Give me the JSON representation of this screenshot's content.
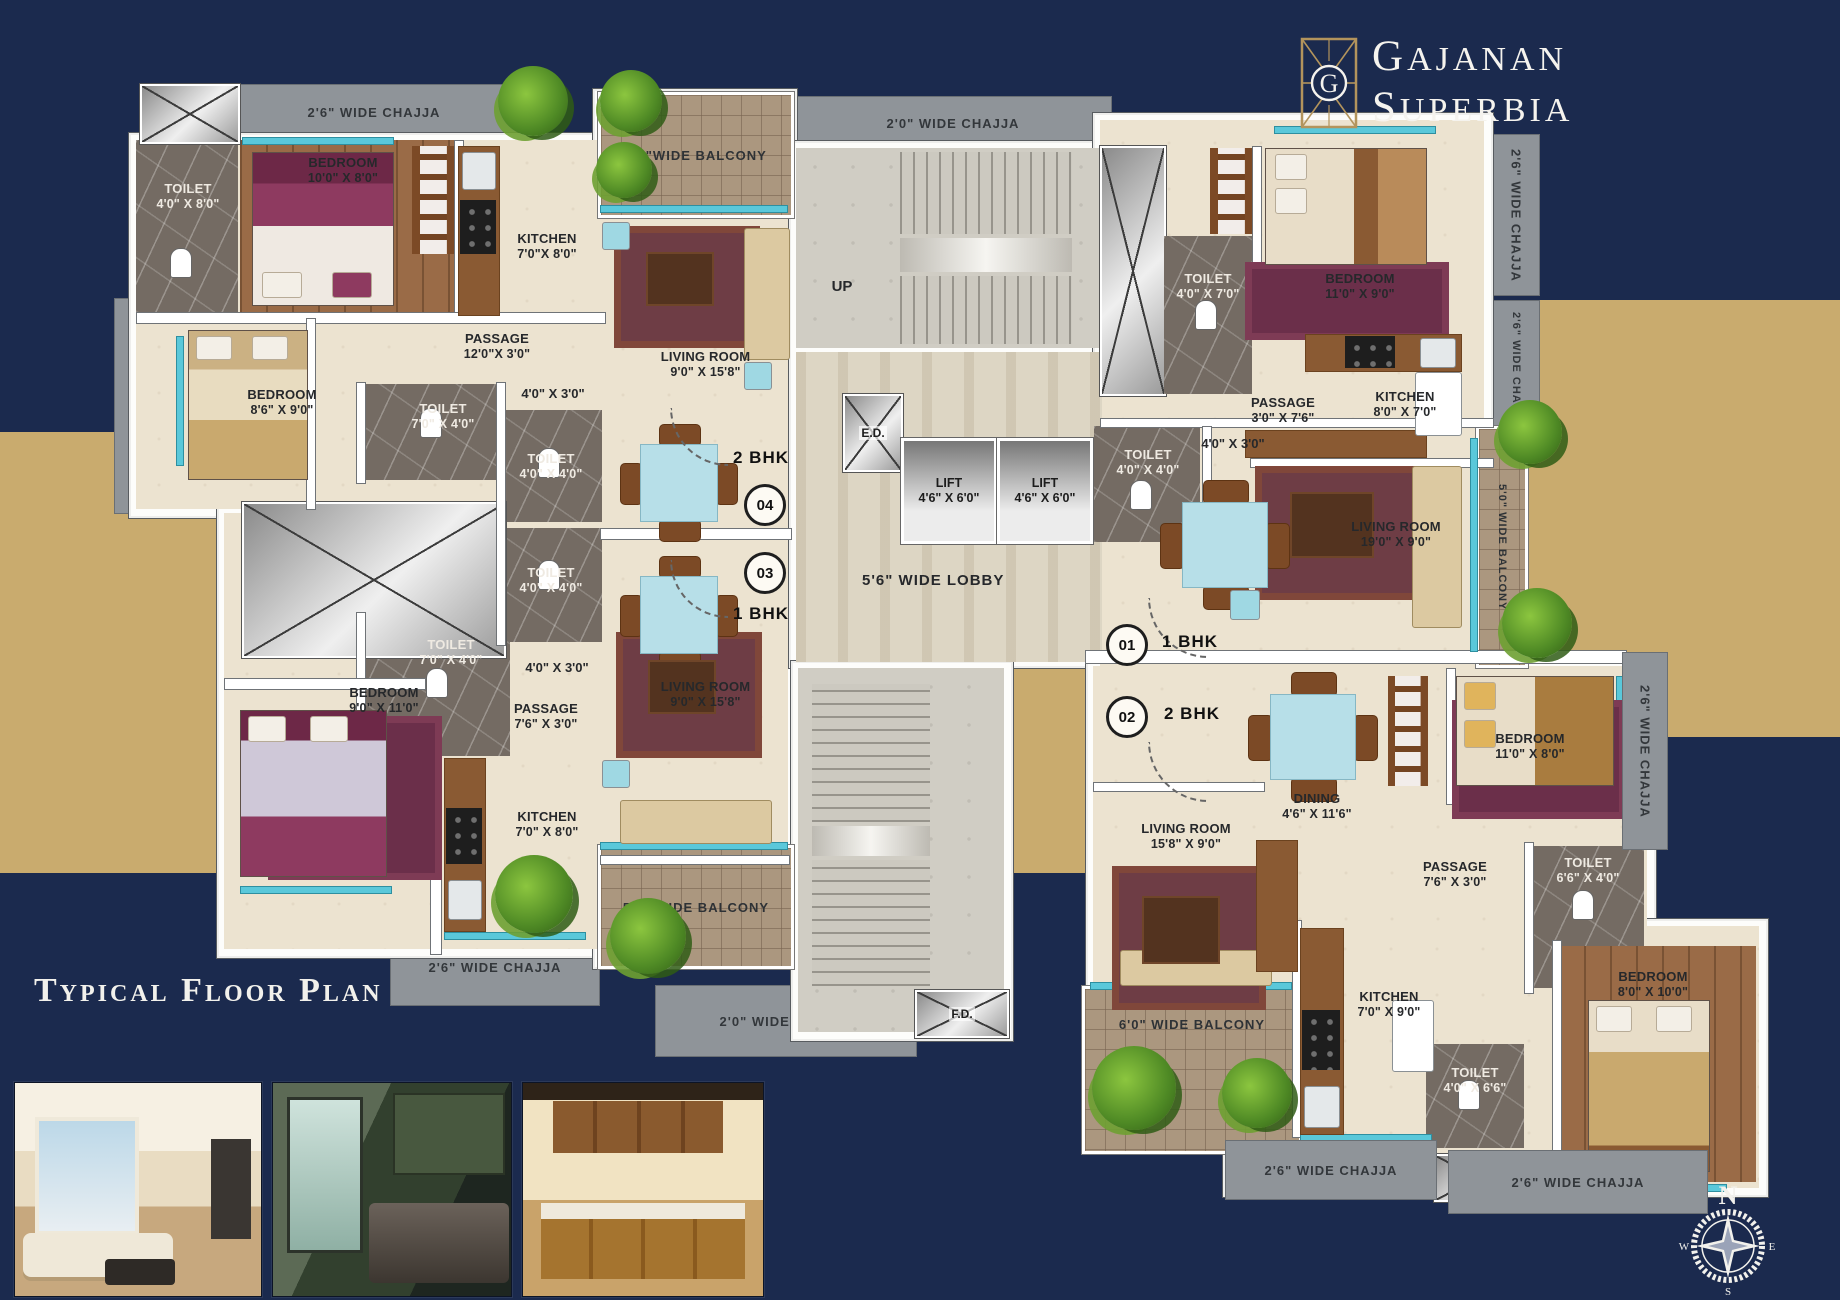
{
  "brand": {
    "line1": "GAJANAN",
    "line2": "SUPERBIA",
    "monogram": "G"
  },
  "title": "Typical Floor Plan",
  "compass": {
    "north": "N",
    "east": "E",
    "south": "S",
    "west": "W"
  },
  "colors": {
    "navy": "#1b2a4e",
    "gold": "#c9ab6e",
    "chajja_gray": "#8f9499",
    "floor_beige": "#ece3d0",
    "accent_teal": "#5ac8da",
    "logo_gold": "#b3945c"
  },
  "core": {
    "up": "UP",
    "ed": "E.D.",
    "fd": "F.D.",
    "lobby": "5'6\" WIDE LOBBY",
    "lift1": {
      "name": "LIFT",
      "dims": "4'6\" X 6'0\""
    },
    "lift2": {
      "name": "LIFT",
      "dims": "4'6\" X 6'0\""
    }
  },
  "flats": [
    {
      "number": "04",
      "type": "2 BHK"
    },
    {
      "number": "03",
      "type": "1 BHK"
    },
    {
      "number": "01",
      "type": "1 BHK"
    },
    {
      "number": "02",
      "type": "2 BHK"
    }
  ],
  "rooms": {
    "toilet_l1": {
      "name": "TOILET",
      "dims": "4'0\" X 8'0\""
    },
    "bedroom_l1": {
      "name": "BEDROOM",
      "dims": "10'0\" X 8'0\""
    },
    "kitchen_l1": {
      "name": "KITCHEN",
      "dims": "7'0\"X 8'0\""
    },
    "living_l1": {
      "name": "LIVING ROOM",
      "dims": "9'0\" X 15'8\""
    },
    "passage_l1": {
      "name": "PASSAGE",
      "dims": "12'0\"X 3'0\""
    },
    "bedroom_l2": {
      "name": "BEDROOM",
      "dims": "8'6\" X 9'0\""
    },
    "toilet_l2": {
      "name": "TOILET",
      "dims": "7'0\" X 4'0\""
    },
    "toilet_l3": {
      "name": "TOILET",
      "dims": "4'0\" X 4'0\""
    },
    "toilet_l4": {
      "name": "TOILET",
      "dims": "4'0\" X 4'0\""
    },
    "toilet_l5": {
      "name": "TOILET",
      "dims": "7'0\" X 4'0\""
    },
    "bedroom_l3": {
      "name": "BEDROOM",
      "dims": "9'0\" X 11'0\""
    },
    "passage_l2": {
      "name": "PASSAGE",
      "dims": "7'6\" X 3'0\""
    },
    "living_l2": {
      "name": "LIVING ROOM",
      "dims": "9'0\" X 15'8\""
    },
    "kitchen_l2": {
      "name": "KITCHEN",
      "dims": "7'0\" X 8'0\""
    },
    "toilet_r1": {
      "name": "TOILET",
      "dims": "4'0\" X 7'0\""
    },
    "bedroom_r1": {
      "name": "BEDROOM",
      "dims": "11'0\" X 9'0\""
    },
    "kitchen_r1": {
      "name": "KITCHEN",
      "dims": "8'0\" X 7'0\""
    },
    "passage_r1": {
      "name": "PASSAGE",
      "dims": "3'0\" X 7'6\""
    },
    "toilet_r2": {
      "name": "TOILET",
      "dims": "4'0\" X 4'0\""
    },
    "living_r1": {
      "name": "LIVING ROOM",
      "dims": "19'0\" X 9'0\""
    },
    "dining_r": {
      "name": "DINING",
      "dims": "4'6\" X 11'6\""
    },
    "living_r2": {
      "name": "LIVING ROOM",
      "dims": "15'8\" X 9'0\""
    },
    "bedroom_r2": {
      "name": "BEDROOM",
      "dims": "11'0\" X 8'0\""
    },
    "passage_r2": {
      "name": "PASSAGE",
      "dims": "7'6\" X 3'0\""
    },
    "toilet_r3": {
      "name": "TOILET",
      "dims": "6'6\" X 4'0\""
    },
    "kitchen_r2": {
      "name": "KITCHEN",
      "dims": "7'0\" X 9'0\""
    },
    "bedroom_r3": {
      "name": "BEDROOM",
      "dims": "8'0\" X 10'0\""
    },
    "toilet_r4": {
      "name": "TOILET",
      "dims": "4'0\" X 6'6\""
    }
  },
  "dims_labels": {
    "l1": "4'0\" X 3'0\"",
    "l2": "4'0\" X 3'0\"",
    "r1": "4'0\" X 3'0\""
  },
  "chajjas": {
    "top_left": "2'6\" WIDE CHAJJA",
    "left_vertical": "2'6\" WIDE CHAJJA",
    "top_center": "2'0\" WIDE CHAJJA",
    "right_top": "2'6\" WIDE CHAJJA",
    "right_upper": "2'6\" WIDE CHAJJA",
    "right_mid": "2'6\" WIDE CHAJJA",
    "bottom_left_1": "2'6\" WIDE CHAJJA",
    "bottom_left_2": "2'6\" WIDE CHAJJA",
    "bottom_center": "2'0\" WIDE CHAJJA",
    "bottom_right_1": "2'6\" WIDE CHAJJA",
    "bottom_right_2": "2'6\" WIDE CHAJJA"
  },
  "balconies": {
    "top_left": "6'0\"WIDE BALCONY",
    "bottom_left": "5'0\" WIDE BALCONY",
    "right_vertical": "5'0\" WIDE BALCONY",
    "bottom_right": "6'0\" WIDE BALCONY"
  }
}
